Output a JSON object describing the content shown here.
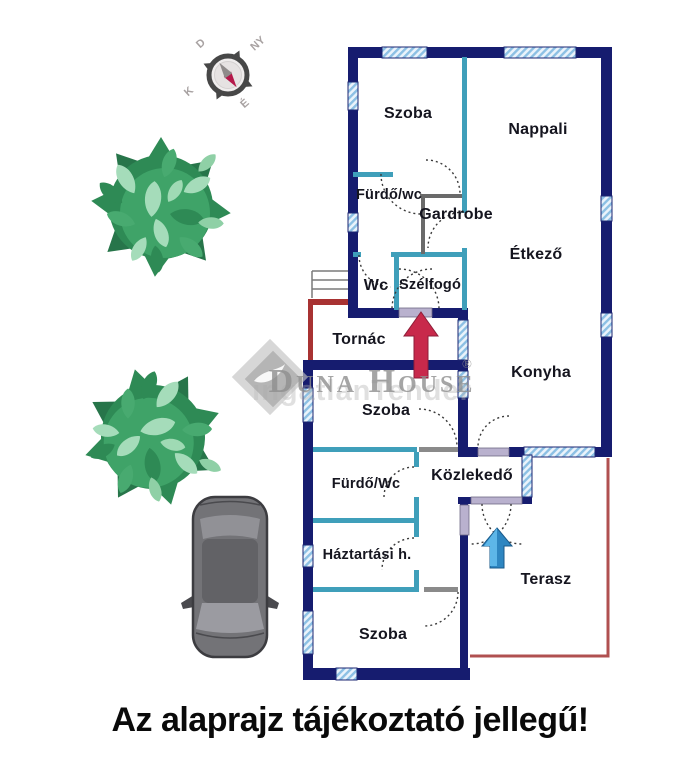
{
  "rooms": {
    "szoba_top": "Szoba",
    "nappali": "Nappali",
    "furdo_wc_top": "Fürdő/wc",
    "gardrobe": "Gardrobe",
    "etkezo": "Étkező",
    "wc": "Wc",
    "szelfogo": "Szélfogó",
    "tornac": "Tornác",
    "konyha": "Konyha",
    "szoba_mid": "Szoba",
    "furdo_wc_mid": "Fürdő/Wc",
    "kozlekedo": "Közlekedő",
    "haztartasi": "Háztartási h.",
    "terasz": "Terasz",
    "szoba_bottom": "Szoba"
  },
  "compass": {
    "north": "É",
    "south": "D",
    "east": "K",
    "west": "NY"
  },
  "watermark": {
    "brand": "Duna House",
    "registered": "®",
    "secondary": "ingatlanTender"
  },
  "footer": {
    "disclaimer": "Az alaprajz tájékoztató jellegű!"
  },
  "colors": {
    "exterior_wall": "#161c6f",
    "interior_wall": "#3f9fba",
    "window_hatch": "#8cc0e4",
    "terrace_line": "#b05050",
    "entrance_arrow": "#c8294b",
    "terrace_arrow": "#2e86c1",
    "bush_green": "#379a5f",
    "label_text": "#15151f"
  }
}
